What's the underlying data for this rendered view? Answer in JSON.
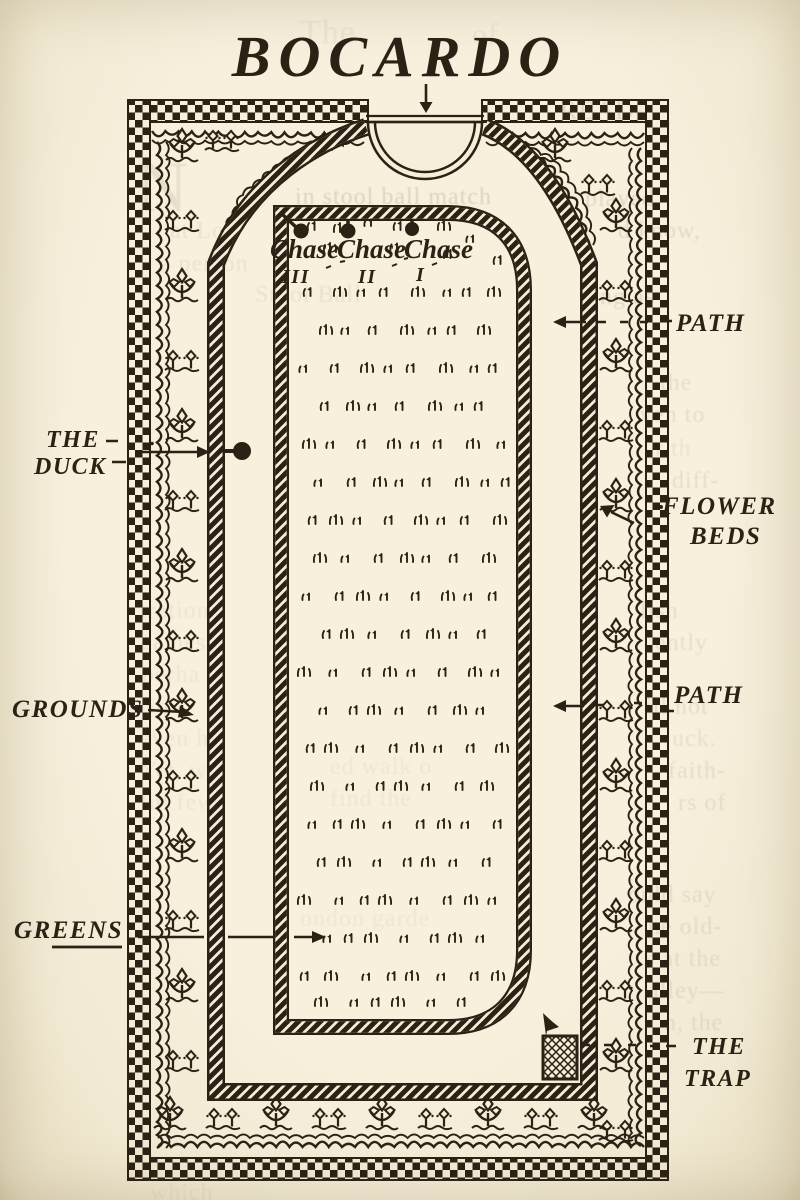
{
  "page": {
    "title": "BOCARDO"
  },
  "court": {
    "chases": [
      "Chase",
      "Chase",
      "Chase"
    ],
    "chase_numbers": [
      "III",
      "II",
      "I"
    ]
  },
  "labels": {
    "duck_line1": "THE",
    "duck_line2": "DUCK",
    "grounds": "GROUNDS",
    "greens": "GREENS",
    "path_top": "PATH",
    "flower_line1": "FLOWER",
    "flower_line2": "BEDS",
    "path_mid": "PATH",
    "trap_line1": "THE",
    "trap_line2": "TRAP"
  },
  "colors": {
    "ink": "#2b2114",
    "paper": "#f4eedb",
    "bleed": "#8f856a"
  },
  "bleed_fragments": [
    {
      "x": 300,
      "y": 14,
      "t": "The",
      "s": 34,
      "o": 0.1
    },
    {
      "x": 472,
      "y": 18,
      "t": "of",
      "s": 30,
      "o": 0.1
    },
    {
      "x": 560,
      "y": 96,
      "t": "READ-",
      "s": 26,
      "o": 0.22
    },
    {
      "x": 136,
      "y": 146,
      "t": "N",
      "s": 72,
      "o": 0.15
    },
    {
      "x": 295,
      "y": 184,
      "t": "in stool ball match",
      "s": 24,
      "o": 0.26
    },
    {
      "x": 585,
      "y": 186,
      "t": "played",
      "s": 24,
      "o": 0.22
    },
    {
      "x": 170,
      "y": 218,
      "t": "at Lo",
      "s": 24,
      "o": 0.13
    },
    {
      "x": 618,
      "y": 218,
      "t": "d know,",
      "s": 24,
      "o": 0.2
    },
    {
      "x": 160,
      "y": 251,
      "t": "a person",
      "s": 24,
      "o": 0.13
    },
    {
      "x": 255,
      "y": 282,
      "t": "Stool Ball",
      "s": 24,
      "o": 0.13
    },
    {
      "x": 600,
      "y": 284,
      "t": "ng as",
      "s": 24,
      "o": 0.2
    },
    {
      "x": 660,
      "y": 370,
      "t": "the",
      "s": 24,
      "o": 0.17
    },
    {
      "x": 640,
      "y": 402,
      "t": "ven to",
      "s": 24,
      "o": 0.17
    },
    {
      "x": 655,
      "y": 436,
      "t": "r th",
      "s": 24,
      "o": 0.12
    },
    {
      "x": 672,
      "y": 468,
      "t": "diff-",
      "s": 24,
      "o": 0.17
    },
    {
      "x": 640,
      "y": 598,
      "t": "lish",
      "s": 24,
      "o": 0.17
    },
    {
      "x": 655,
      "y": 630,
      "t": "ently",
      "s": 24,
      "o": 0.17
    },
    {
      "x": 645,
      "y": 694,
      "t": "ill not",
      "s": 24,
      "o": 0.17
    },
    {
      "x": 672,
      "y": 726,
      "t": "uck.",
      "s": 24,
      "o": 0.15
    },
    {
      "x": 668,
      "y": 758,
      "t": "faith-",
      "s": 24,
      "o": 0.17
    },
    {
      "x": 678,
      "y": 790,
      "t": "rs of",
      "s": 24,
      "o": 0.17
    },
    {
      "x": 628,
      "y": 882,
      "t": "ould say",
      "s": 24,
      "o": 0.17
    },
    {
      "x": 648,
      "y": 914,
      "t": "he old-",
      "s": 24,
      "o": 0.17
    },
    {
      "x": 645,
      "y": 946,
      "t": "s at the",
      "s": 24,
      "o": 0.17
    },
    {
      "x": 648,
      "y": 978,
      "t": "alley—",
      "s": 24,
      "o": 0.17
    },
    {
      "x": 664,
      "y": 1010,
      "t": "n, the",
      "s": 24,
      "o": 0.17
    },
    {
      "x": 140,
      "y": 598,
      "t": "tration",
      "s": 24,
      "o": 0.1
    },
    {
      "x": 140,
      "y": 630,
      "t": "games",
      "s": 24,
      "o": 0.1
    },
    {
      "x": 142,
      "y": 662,
      "t": "perha",
      "s": 24,
      "o": 0.1
    },
    {
      "x": 142,
      "y": 694,
      "t": "So I",
      "s": 24,
      "o": 0.1
    },
    {
      "x": 140,
      "y": 726,
      "t": "even he",
      "s": 24,
      "o": 0.1
    },
    {
      "x": 140,
      "y": 758,
      "t": "Yet, wh",
      "s": 24,
      "o": 0.1
    },
    {
      "x": 140,
      "y": 790,
      "t": "ful few",
      "s": 24,
      "o": 0.1
    },
    {
      "x": 330,
      "y": 754,
      "t": "ed walk o",
      "s": 24,
      "o": 0.09
    },
    {
      "x": 330,
      "y": 786,
      "t": "find the",
      "s": 24,
      "o": 0.09
    },
    {
      "x": 300,
      "y": 906,
      "t": "ondon garde",
      "s": 24,
      "o": 0.09
    },
    {
      "x": 150,
      "y": 1180,
      "t": "which",
      "s": 24,
      "o": 0.1
    }
  ]
}
